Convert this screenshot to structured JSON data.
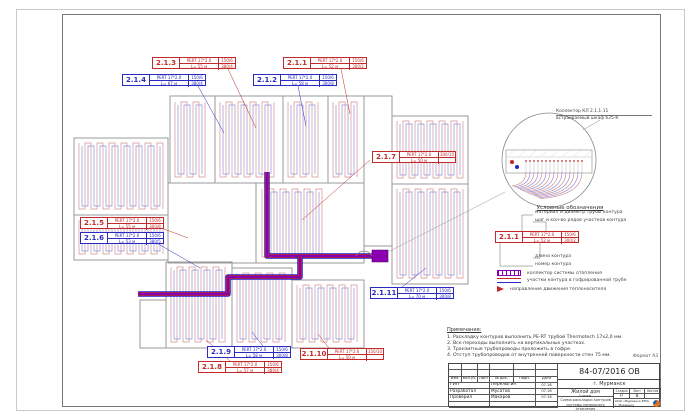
{
  "sheet": {
    "doc_number": "84-07/2016 ОВ",
    "city": "г. Мурманск",
    "object_name": "Жилой дом",
    "sheet_title_line1": "2 этаж.",
    "sheet_title_line2": "Схема раскладки контуров системы напольного отопления",
    "format_note": "Формат А3",
    "stamp": {
      "cols": [
        "Изм.",
        "Кол.уч.",
        "Лист",
        "№ док.",
        "Подп.",
        "Дата"
      ],
      "rows": [
        {
          "role": "ГИП",
          "name": "Перелыгин",
          "date": "07.16"
        },
        {
          "role": "Разработал",
          "name": "Мусатов",
          "date": "07.16"
        },
        {
          "role": "Проверил",
          "name": "Макаров",
          "date": "07.16"
        }
      ],
      "stage_label": "Стадия",
      "sheet_label": "Лист",
      "sheets_label": "Листов",
      "stage_value": "Р",
      "sheet_value": "8",
      "sheets_value": "",
      "company_line1": "ООО «Мурманск-РТИ»",
      "company_line2": "г. Мурманск"
    }
  },
  "detail": {
    "callout_line1": "Коллектор КЛ 2.1.1-11",
    "callout_line2": "встраиваемый шкаф 625-К"
  },
  "legend": {
    "title": "Условные обозначения",
    "pointer_pipe": "материал и диаметр трубы контура",
    "pointer_step": "шаг и кол-во рядов участков контура",
    "pointer_length": "длина контура",
    "pointer_number": "номер контура",
    "sample": {
      "id": "2.1.1",
      "color": "red",
      "pipe": "PERT 17*2.0",
      "cell1": "150/6",
      "length": "L= 52 м",
      "cell2": "300/2"
    },
    "items": [
      {
        "icon": "collector-symbol",
        "label": "коллектор системы отопления"
      },
      {
        "icon": "corrugated-pipe-symbol",
        "label": "участки контура в гофрированной трубе"
      },
      {
        "icon": "flow-direction-arrow",
        "label": "направление движения теплоносителя"
      }
    ]
  },
  "notes": {
    "title": "Примечания:",
    "lines": [
      "1. Раскладку контуров выполнить PE-RT трубой Thermotech 17х2,0 мм.",
      "2. Все переходы выполнить на вертикальных участках.",
      "3. Транзитные трубопроводы проложить в гофре.",
      "4. Отступ трубопроводов от внутренней поверхности стен 75 мм."
    ]
  },
  "tags": [
    {
      "id": "2.1.1",
      "color": "red",
      "pipe": "PERT 17*2.0",
      "cell1": "150/6",
      "length": "L= 52 м",
      "cell2": "300/2",
      "x": 283,
      "y": 57,
      "leader": [
        341,
        69,
        350,
        114
      ]
    },
    {
      "id": "2.1.2",
      "color": "blue",
      "pipe": "PERT 17*2.0",
      "cell1": "150/6",
      "length": "L= 58 м",
      "cell2": "300/8",
      "x": 253,
      "y": 74,
      "leader": [
        298,
        86,
        306,
        126
      ]
    },
    {
      "id": "2.1.3",
      "color": "red",
      "pipe": "PERT 17*2.0",
      "cell1": "150/6",
      "length": "L= 55 м",
      "cell2": "380/4",
      "x": 152,
      "y": 57,
      "leader": [
        228,
        69,
        256,
        128
      ]
    },
    {
      "id": "2.1.4",
      "color": "blue",
      "pipe": "PERT 17*2.0",
      "cell1": "150/6",
      "length": "L= 67 м",
      "cell2": "380/4",
      "x": 122,
      "y": 74,
      "leader": [
        198,
        86,
        224,
        133
      ]
    },
    {
      "id": "2.1.5",
      "color": "red",
      "pipe": "PERT 17*2.0",
      "cell1": "150/6",
      "length": "L= 55 м",
      "cell2": "300/8",
      "x": 80,
      "y": 217,
      "leader": [
        148,
        223,
        188,
        238
      ]
    },
    {
      "id": "2.1.6",
      "color": "blue",
      "pipe": "PERT 17*2.0",
      "cell1": "150/6",
      "length": "L= 53 м",
      "cell2": "380/5",
      "x": 80,
      "y": 232,
      "leader": [
        148,
        238,
        200,
        268
      ]
    },
    {
      "id": "2.1.7",
      "color": "red",
      "pipe": "PERT 17*2.0",
      "cell1": "300/10",
      "length": "L= 50 м",
      "cell2": "",
      "x": 372,
      "y": 151,
      "leader": [
        370,
        160,
        302,
        220
      ]
    },
    {
      "id": "2.1.8",
      "color": "red",
      "pipe": "PERT 17*2.0",
      "cell1": "150/6",
      "length": "L= 57 м",
      "cell2": "380/4",
      "x": 198,
      "y": 361,
      "leader": [
        230,
        361,
        206,
        340
      ]
    },
    {
      "id": "2.1.9",
      "color": "blue",
      "pipe": "PERT 17*2.0",
      "cell1": "150/6",
      "length": "L= 58 м",
      "cell2": "300/8",
      "x": 207,
      "y": 346,
      "leader": [
        266,
        350,
        252,
        332
      ]
    },
    {
      "id": "2.1.10",
      "color": "red",
      "pipe": "PERT 17*2.0",
      "cell1": "150/10",
      "length": "L= 50 м",
      "cell2": "",
      "x": 300,
      "y": 348,
      "leader": [
        332,
        352,
        318,
        334
      ]
    },
    {
      "id": "2.1.11",
      "color": "blue",
      "pipe": "PERT 17*2.0",
      "cell1": "150/6",
      "length": "L= 70 м",
      "cell2": "300/8",
      "x": 370,
      "y": 287,
      "leader": [
        402,
        287,
        426,
        268
      ]
    }
  ],
  "colors": {
    "tag_red": "#c22a2a",
    "tag_blue": "#2a2ac2",
    "coil_red": "#d89090",
    "coil_blue": "#9090d8",
    "trunk_red": "#cc2222",
    "trunk_blue": "#2222cc",
    "trunk_purple": "#8a00b0",
    "wall": "#9a9a9a",
    "frame": "#777777"
  },
  "plan": {
    "walls": [
      [
        170,
        96,
        113,
        87
      ],
      [
        283,
        96,
        81,
        87
      ],
      [
        364,
        96,
        28,
        150
      ],
      [
        392,
        116,
        76,
        68
      ],
      [
        392,
        184,
        76,
        100
      ],
      [
        74,
        138,
        94,
        122
      ],
      [
        168,
        183,
        88,
        80
      ],
      [
        256,
        183,
        108,
        80
      ],
      [
        166,
        262,
        66,
        86
      ],
      [
        232,
        268,
        60,
        80
      ],
      [
        292,
        280,
        72,
        68
      ],
      [
        140,
        300,
        26,
        48
      ]
    ],
    "wall_lines": [
      [
        215,
        96,
        215,
        183
      ],
      [
        328,
        96,
        328,
        183
      ],
      [
        74,
        215,
        168,
        215
      ]
    ],
    "coils": [
      [
        171,
        98,
        43,
        83
      ],
      [
        216,
        98,
        66,
        83
      ],
      [
        284,
        98,
        43,
        83
      ],
      [
        329,
        98,
        34,
        83
      ],
      [
        393,
        117,
        74,
        65
      ],
      [
        393,
        185,
        74,
        97
      ],
      [
        258,
        185,
        72,
        76
      ],
      [
        75,
        139,
        92,
        74
      ],
      [
        75,
        216,
        92,
        42
      ],
      [
        167,
        263,
        64,
        83
      ],
      [
        233,
        269,
        58,
        77
      ],
      [
        293,
        281,
        70,
        65
      ]
    ],
    "trunk": [
      [
        [
          267,
          172
        ],
        [
          267,
          256
        ],
        [
          372,
          256
        ]
      ],
      [
        [
          300,
          256
        ],
        [
          300,
          277
        ],
        [
          228,
          277
        ],
        [
          228,
          294
        ],
        [
          138,
          294
        ]
      ]
    ],
    "collector_rect": [
      372,
      250,
      16,
      12
    ],
    "detail_link": [
      388,
      252,
      505,
      192
    ],
    "detail_circle": {
      "cx": 549,
      "cy": 160,
      "r": 47
    }
  }
}
